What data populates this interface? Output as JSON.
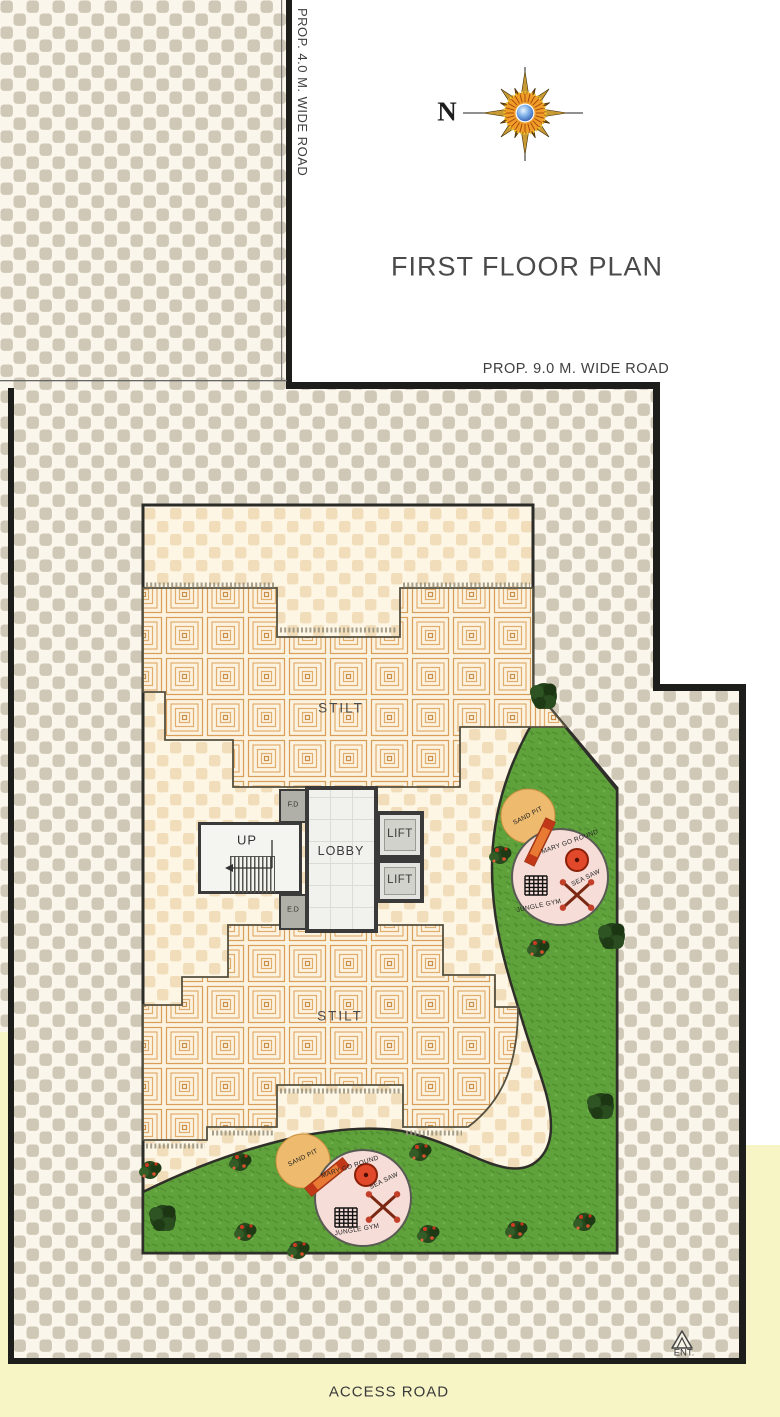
{
  "title": "FIRST FLOOR PLAN",
  "compass": {
    "north": "N"
  },
  "roads": {
    "west_vertical": "PROP. 4.0 M. WIDE ROAD",
    "north_horizontal": "PROP. 9.0 M. WIDE ROAD",
    "south": "ACCESS ROAD"
  },
  "entrance": {
    "label": "ENT."
  },
  "stilt": {
    "upper": "STILT",
    "lower": "STILT"
  },
  "core": {
    "lobby": "LOBBY",
    "lift_upper": "LIFT",
    "lift_lower": "LIFT",
    "stair": "UP",
    "duct_top": "F.D",
    "duct_bottom": "E.D"
  },
  "playground_upper": {
    "sand_pit": "SAND PIT",
    "merry_go_round": "MARY GO ROUND",
    "sea_saw": "SEA SAW",
    "jungle_gym": "JUNGLE GYM"
  },
  "playground_lower": {
    "sand_pit": "SAND PIT",
    "merry_go_round": "MARY GO ROUND",
    "sea_saw": "SEA SAW",
    "jungle_gym": "JUNGLE GYM"
  },
  "colors": {
    "outer_checker_tan": "#cfc8b6",
    "outer_checker_bg": "#faf6ec",
    "inner_checker_peach": "#f1ddba",
    "inner_checker_bg": "#fdf6e4",
    "tile_line": "#e2ac6c",
    "tile_bg": "#fcf2e0",
    "grass_green": "#5fa23c",
    "sand_pit_orange": "#edba6e",
    "play_circle_pink": "#f6ddd8",
    "road_yellow": "#f7f4c6",
    "boundary_black": "#1d1d1b",
    "wall_gray": "#3a3a3a"
  }
}
